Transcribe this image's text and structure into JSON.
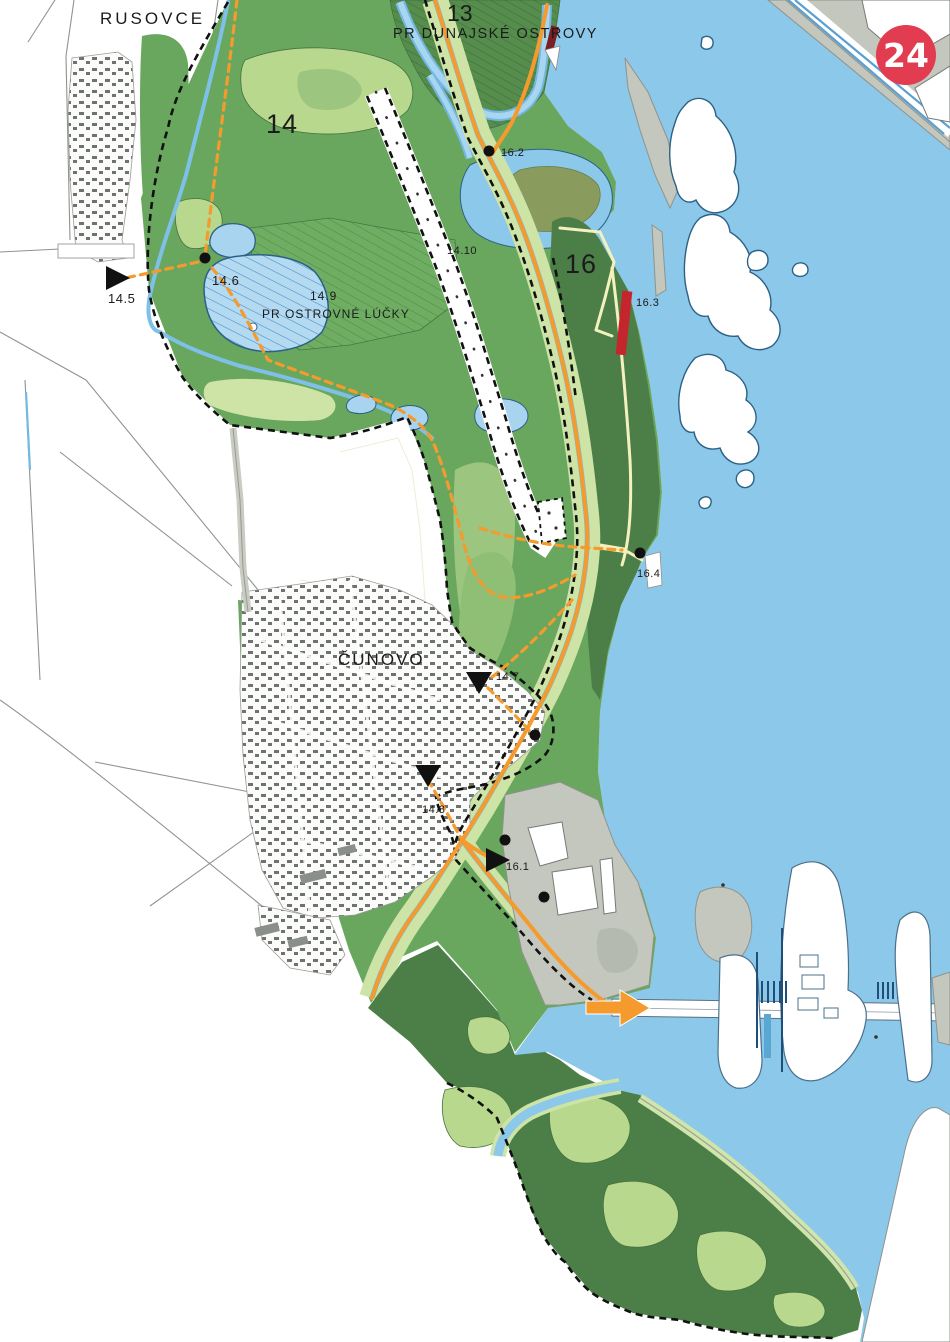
{
  "map_title": "Protected areas and visitor routes map — Rusovce / Čunovo / Danube",
  "labels": {
    "rusovce": "RUSOVCE",
    "cunovo": "ČUNOVO",
    "zone_13": "13",
    "zone_14": "14",
    "zone_16": "16",
    "pr_dunajske_ostrovy": "PR DUNAJSKÉ OSTROVY",
    "pr_ostrovne_lucky": "PR OSTROVNÉ LÚČKY",
    "m_14_5": "14.5",
    "m_14_6": "14.6",
    "m_14_7": "14.7",
    "m_14_8": "14.8",
    "m_14_9": "14.9",
    "m_14_10": "14.10",
    "m_16_1": "16.1",
    "m_16_2": "16.2",
    "m_16_3": "16.3",
    "m_16_4": "16.4"
  },
  "watermark": {
    "text": "24",
    "bg_color": "#e23c50",
    "text_color": "#ffffff"
  },
  "colors": {
    "water": "#8cc8e9",
    "water_outline": "#2c6186",
    "forest_main": "#69a75e",
    "forest_dark": "#4c7f47",
    "forest_light": "#b7d88d",
    "pale_green": "#cde4a6",
    "lake_blue": "#a9d4ef",
    "route_orange": "#f59b2d",
    "path_yellow": "#f5f1bf",
    "boundary_black": "#111111",
    "marker_red": "#c5252c",
    "marker_dark_red": "#7c1f22",
    "gray_land": "#c3c7be",
    "urban_gray": "#6e7270"
  }
}
